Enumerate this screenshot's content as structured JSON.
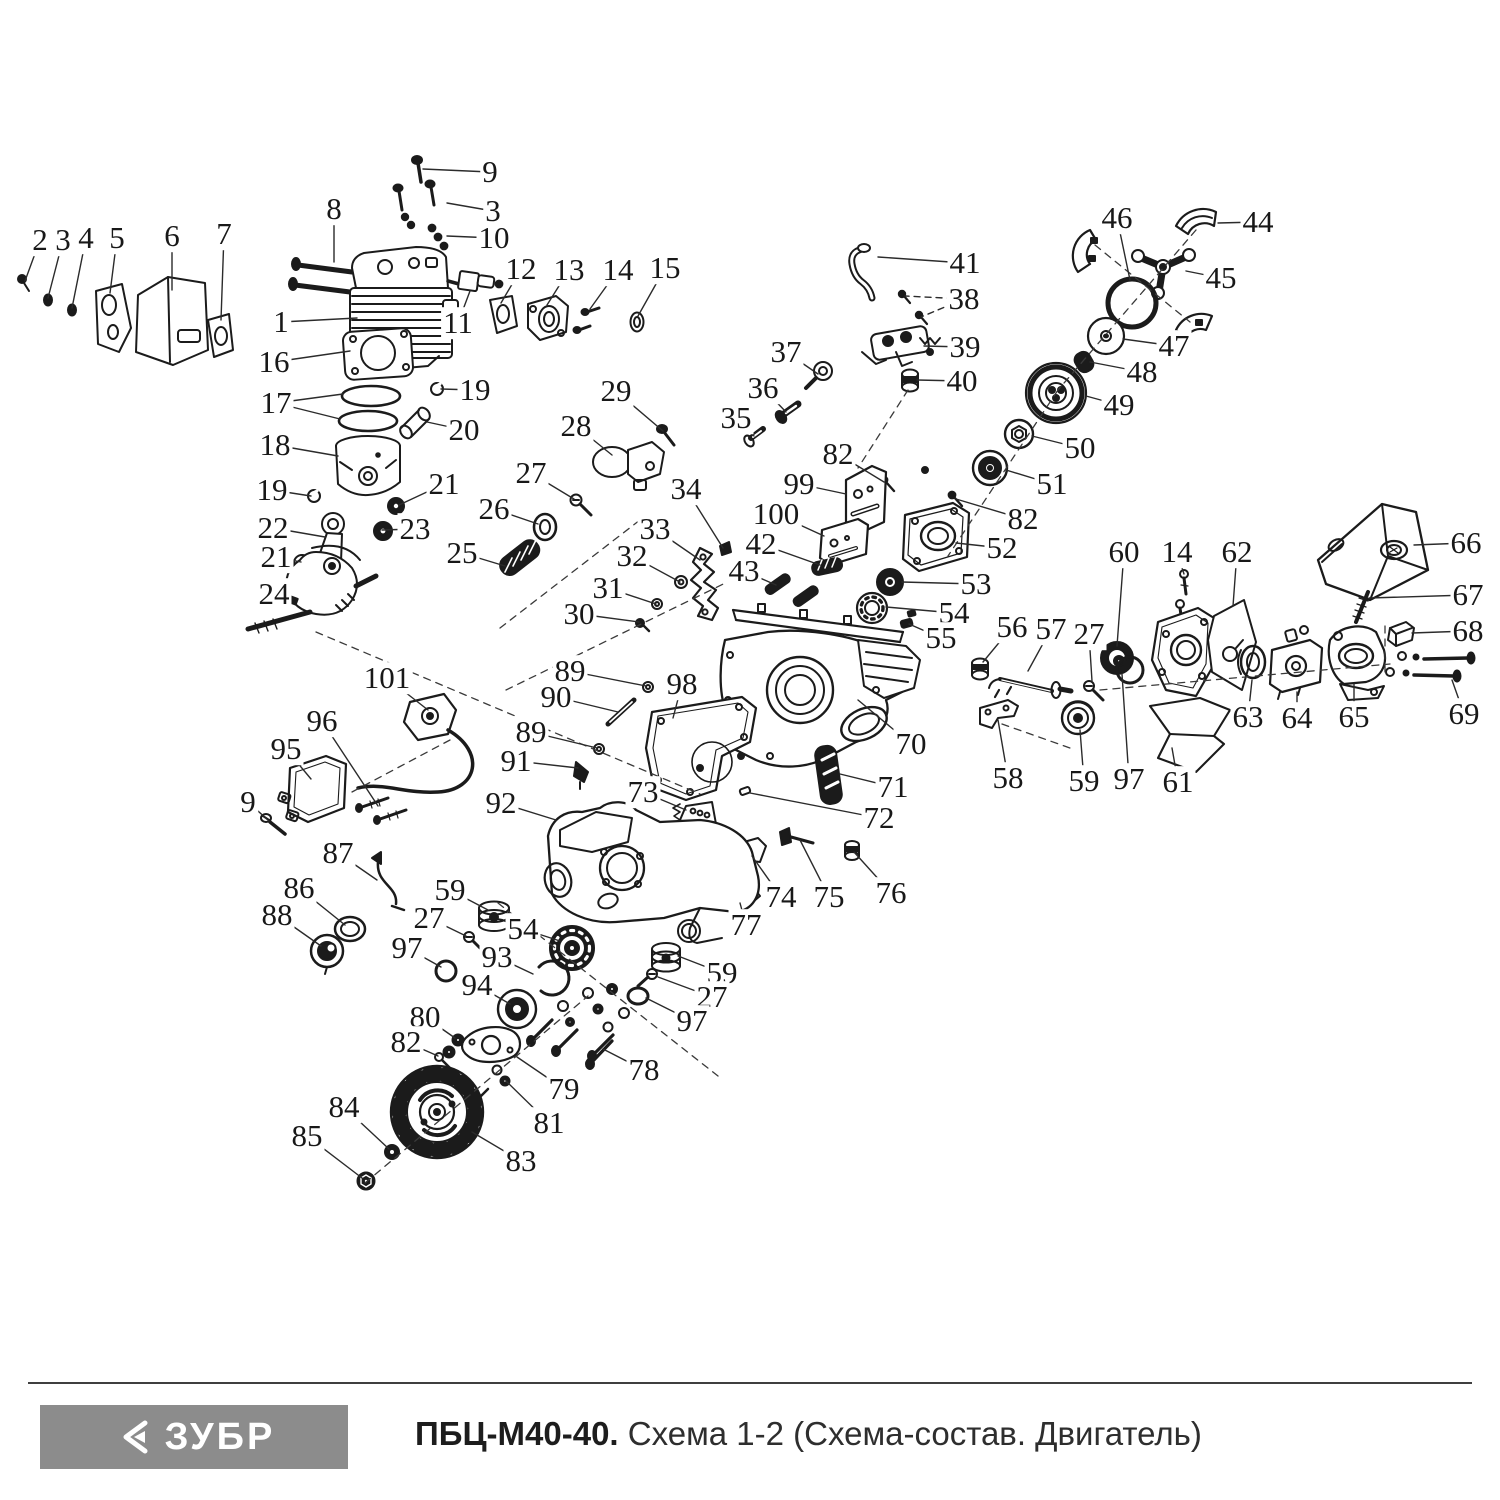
{
  "colors": {
    "ink": "#1b1b1b",
    "logo_gray": "#8c8c8c",
    "background": "#ffffff"
  },
  "footer": {
    "logo_text": "ЗУБР",
    "model": "ПБЦ-М40-40.",
    "subtitle": "Схема 1-2 (Схема-состав. Двигатель)"
  },
  "diagram": {
    "labels": [
      {
        "n": "2",
        "x": 40,
        "y": 240,
        "t": [
          25,
          281
        ]
      },
      {
        "n": "3",
        "x": 63,
        "y": 240,
        "t": [
          48,
          298
        ]
      },
      {
        "n": "4",
        "x": 86,
        "y": 238,
        "t": [
          72,
          308
        ]
      },
      {
        "n": "5",
        "x": 117,
        "y": 238,
        "t": [
          110,
          293
        ]
      },
      {
        "n": "6",
        "x": 172,
        "y": 236,
        "t": [
          172,
          290
        ]
      },
      {
        "n": "7",
        "x": 224,
        "y": 234,
        "t": [
          221,
          320
        ]
      },
      {
        "n": "8",
        "x": 334,
        "y": 209,
        "t": [
          334,
          262
        ]
      },
      {
        "n": "9",
        "x": 490,
        "y": 172,
        "t": [
          423,
          169
        ]
      },
      {
        "n": "3",
        "x": 493,
        "y": 211,
        "t": [
          447,
          203
        ]
      },
      {
        "n": "10",
        "x": 494,
        "y": 238,
        "t": [
          447,
          236
        ]
      },
      {
        "n": "1",
        "x": 281,
        "y": 322,
        "t": [
          357,
          318
        ]
      },
      {
        "n": "11",
        "x": 458,
        "y": 323,
        "t": [
          470,
          291
        ]
      },
      {
        "n": "12",
        "x": 521,
        "y": 269,
        "t": [
          501,
          303
        ]
      },
      {
        "n": "13",
        "x": 569,
        "y": 270,
        "t": [
          547,
          305
        ]
      },
      {
        "n": "14",
        "x": 618,
        "y": 270,
        "t": [
          590,
          309
        ]
      },
      {
        "n": "15",
        "x": 665,
        "y": 268,
        "t": [
          638,
          316
        ]
      },
      {
        "n": "16",
        "x": 274,
        "y": 362,
        "t": [
          350,
          351
        ]
      },
      {
        "n": "17",
        "x": 276,
        "y": 403,
        "t": [
          343,
          394
        ],
        "t2": [
          340,
          419
        ]
      },
      {
        "n": "18",
        "x": 275,
        "y": 445,
        "t": [
          338,
          456
        ]
      },
      {
        "n": "19",
        "x": 475,
        "y": 390,
        "t": [
          441,
          389
        ]
      },
      {
        "n": "20",
        "x": 464,
        "y": 430,
        "t": [
          427,
          422
        ]
      },
      {
        "n": "21",
        "x": 444,
        "y": 484,
        "t": [
          399,
          505
        ]
      },
      {
        "n": "19",
        "x": 272,
        "y": 490,
        "t": [
          311,
          496
        ]
      },
      {
        "n": "22",
        "x": 273,
        "y": 528,
        "t": [
          325,
          537
        ]
      },
      {
        "n": "23",
        "x": 415,
        "y": 529,
        "t": [
          382,
          530
        ]
      },
      {
        "n": "21",
        "x": 276,
        "y": 557,
        "t": [
          301,
          562
        ]
      },
      {
        "n": "24",
        "x": 274,
        "y": 594,
        "t": [
          291,
          600
        ]
      },
      {
        "n": "25",
        "x": 462,
        "y": 553,
        "t": [
          505,
          566
        ]
      },
      {
        "n": "26",
        "x": 494,
        "y": 509,
        "t": [
          538,
          524
        ]
      },
      {
        "n": "27",
        "x": 531,
        "y": 473,
        "t": [
          574,
          499
        ]
      },
      {
        "n": "28",
        "x": 576,
        "y": 426,
        "t": [
          612,
          455
        ]
      },
      {
        "n": "29",
        "x": 616,
        "y": 391,
        "t": [
          663,
          431
        ]
      },
      {
        "n": "30",
        "x": 579,
        "y": 614,
        "t": [
          639,
          622
        ]
      },
      {
        "n": "31",
        "x": 608,
        "y": 588,
        "t": [
          656,
          604
        ]
      },
      {
        "n": "32",
        "x": 632,
        "y": 556,
        "t": [
          680,
          582
        ]
      },
      {
        "n": "33",
        "x": 655,
        "y": 529,
        "t": [
          700,
          560
        ]
      },
      {
        "n": "34",
        "x": 686,
        "y": 489,
        "t": [
          723,
          548
        ]
      },
      {
        "n": "35",
        "x": 736,
        "y": 418,
        "t": [
          754,
          436
        ]
      },
      {
        "n": "36",
        "x": 763,
        "y": 388,
        "t": [
          786,
          412
        ]
      },
      {
        "n": "37",
        "x": 786,
        "y": 352,
        "t": [
          818,
          374
        ]
      },
      {
        "n": "38",
        "x": 964,
        "y": 299,
        "t": [
          905,
          296
        ],
        "t2": [
          921,
          317
        ],
        "dash": true
      },
      {
        "n": "39",
        "x": 965,
        "y": 347,
        "t": [
          924,
          346
        ]
      },
      {
        "n": "40",
        "x": 962,
        "y": 381,
        "t": [
          917,
          380
        ]
      },
      {
        "n": "41",
        "x": 965,
        "y": 263,
        "t": [
          878,
          257
        ]
      },
      {
        "n": "44",
        "x": 1258,
        "y": 222,
        "t": [
          1218,
          223
        ]
      },
      {
        "n": "45",
        "x": 1221,
        "y": 278,
        "t": [
          1186,
          271
        ]
      },
      {
        "n": "46",
        "x": 1117,
        "y": 218,
        "t": [
          1130,
          280
        ]
      },
      {
        "n": "47",
        "x": 1174,
        "y": 346,
        "t": [
          1123,
          339
        ]
      },
      {
        "n": "48",
        "x": 1142,
        "y": 372,
        "t": [
          1090,
          362
        ]
      },
      {
        "n": "49",
        "x": 1119,
        "y": 405,
        "t": [
          1086,
          396
        ]
      },
      {
        "n": "50",
        "x": 1080,
        "y": 448,
        "t": [
          1032,
          436
        ]
      },
      {
        "n": "51",
        "x": 1052,
        "y": 484,
        "t": [
          1006,
          470
        ]
      },
      {
        "n": "82",
        "x": 838,
        "y": 454,
        "t": [
          884,
          482
        ]
      },
      {
        "n": "82",
        "x": 1023,
        "y": 519,
        "t": [
          956,
          499
        ]
      },
      {
        "n": "99",
        "x": 799,
        "y": 484,
        "t": [
          846,
          494
        ]
      },
      {
        "n": "100",
        "x": 776,
        "y": 514,
        "t": [
          824,
          536
        ]
      },
      {
        "n": "42",
        "x": 761,
        "y": 544,
        "t": [
          820,
          565
        ]
      },
      {
        "n": "43",
        "x": 744,
        "y": 571,
        "t": [
          776,
          585
        ]
      },
      {
        "n": "52",
        "x": 1002,
        "y": 548,
        "t": [
          956,
          543
        ]
      },
      {
        "n": "53",
        "x": 976,
        "y": 584,
        "t": [
          902,
          582
        ]
      },
      {
        "n": "54",
        "x": 954,
        "y": 613,
        "t": [
          886,
          607
        ]
      },
      {
        "n": "55",
        "x": 941,
        "y": 638,
        "t": [
          909,
          624
        ]
      },
      {
        "n": "56",
        "x": 1012,
        "y": 627,
        "t": [
          983,
          662
        ]
      },
      {
        "n": "57",
        "x": 1051,
        "y": 629,
        "t": [
          1028,
          671
        ]
      },
      {
        "n": "27",
        "x": 1089,
        "y": 634,
        "t": [
          1092,
          681
        ]
      },
      {
        "n": "60",
        "x": 1124,
        "y": 552,
        "t": [
          1117,
          646
        ]
      },
      {
        "n": "14",
        "x": 1177,
        "y": 552,
        "t": [
          1184,
          574
        ]
      },
      {
        "n": "62",
        "x": 1237,
        "y": 552,
        "t": [
          1233,
          606
        ]
      },
      {
        "n": "66",
        "x": 1466,
        "y": 543,
        "t": [
          1414,
          545
        ]
      },
      {
        "n": "67",
        "x": 1468,
        "y": 595,
        "t": [
          1369,
          598
        ]
      },
      {
        "n": "68",
        "x": 1468,
        "y": 631,
        "t": [
          1412,
          633
        ]
      },
      {
        "n": "69",
        "x": 1464,
        "y": 714,
        "t": [
          1452,
          680
        ]
      },
      {
        "n": "63",
        "x": 1248,
        "y": 717,
        "t": [
          1252,
          680
        ]
      },
      {
        "n": "64",
        "x": 1297,
        "y": 718,
        "t": [
          1297,
          692
        ]
      },
      {
        "n": "65",
        "x": 1354,
        "y": 717,
        "t": [
          1354,
          684
        ]
      },
      {
        "n": "70",
        "x": 911,
        "y": 744,
        "t": [
          858,
          700
        ]
      },
      {
        "n": "71",
        "x": 893,
        "y": 787,
        "t": [
          840,
          774
        ]
      },
      {
        "n": "72",
        "x": 879,
        "y": 818,
        "t": [
          750,
          793
        ]
      },
      {
        "n": "58",
        "x": 1008,
        "y": 778,
        "t": [
          998,
          720
        ]
      },
      {
        "n": "59",
        "x": 1084,
        "y": 781,
        "t": [
          1080,
          730
        ]
      },
      {
        "n": "97",
        "x": 1129,
        "y": 779,
        "t": [
          1122,
          674
        ]
      },
      {
        "n": "61",
        "x": 1178,
        "y": 782,
        "t": [
          1172,
          748
        ]
      },
      {
        "n": "73",
        "x": 643,
        "y": 792,
        "t": [
          686,
          810
        ]
      },
      {
        "n": "74",
        "x": 781,
        "y": 897,
        "t": [
          752,
          856
        ]
      },
      {
        "n": "75",
        "x": 829,
        "y": 897,
        "t": [
          800,
          840
        ]
      },
      {
        "n": "76",
        "x": 891,
        "y": 893,
        "t": [
          854,
          852
        ]
      },
      {
        "n": "77",
        "x": 746,
        "y": 925,
        "t": [
          740,
          903
        ]
      },
      {
        "n": "89",
        "x": 570,
        "y": 671,
        "t": [
          646,
          686
        ]
      },
      {
        "n": "90",
        "x": 556,
        "y": 697,
        "t": [
          618,
          712
        ]
      },
      {
        "n": "98",
        "x": 682,
        "y": 684,
        "t": [
          673,
          718
        ]
      },
      {
        "n": "89",
        "x": 531,
        "y": 732,
        "t": [
          597,
          748
        ]
      },
      {
        "n": "91",
        "x": 516,
        "y": 761,
        "t": [
          578,
          768
        ]
      },
      {
        "n": "101",
        "x": 387,
        "y": 678,
        "t": [
          428,
          710
        ]
      },
      {
        "n": "96",
        "x": 322,
        "y": 721,
        "t": [
          378,
          806
        ]
      },
      {
        "n": "95",
        "x": 286,
        "y": 749,
        "t": [
          311,
          779
        ]
      },
      {
        "n": "9",
        "x": 248,
        "y": 802,
        "t": [
          269,
          821
        ]
      },
      {
        "n": "92",
        "x": 501,
        "y": 803,
        "t": [
          556,
          820
        ]
      },
      {
        "n": "87",
        "x": 338,
        "y": 853,
        "t": [
          377,
          880
        ]
      },
      {
        "n": "86",
        "x": 299,
        "y": 888,
        "t": [
          345,
          925
        ]
      },
      {
        "n": "88",
        "x": 277,
        "y": 915,
        "t": [
          321,
          946
        ]
      },
      {
        "n": "59",
        "x": 450,
        "y": 890,
        "t": [
          488,
          910
        ]
      },
      {
        "n": "27",
        "x": 429,
        "y": 918,
        "t": [
          466,
          936
        ]
      },
      {
        "n": "97",
        "x": 407,
        "y": 948,
        "t": [
          441,
          967
        ]
      },
      {
        "n": "54",
        "x": 523,
        "y": 929,
        "t": [
          560,
          941
        ]
      },
      {
        "n": "93",
        "x": 497,
        "y": 957,
        "t": [
          533,
          974
        ]
      },
      {
        "n": "94",
        "x": 477,
        "y": 985,
        "t": [
          510,
          1004
        ]
      },
      {
        "n": "59",
        "x": 722,
        "y": 973,
        "t": [
          678,
          956
        ]
      },
      {
        "n": "27",
        "x": 712,
        "y": 997,
        "t": [
          658,
          977
        ]
      },
      {
        "n": "97",
        "x": 692,
        "y": 1021,
        "t": [
          646,
          998
        ]
      },
      {
        "n": "80",
        "x": 425,
        "y": 1017,
        "t": [
          455,
          1038
        ]
      },
      {
        "n": "82",
        "x": 406,
        "y": 1042,
        "t": [
          438,
          1056
        ]
      },
      {
        "n": "78",
        "x": 644,
        "y": 1070,
        "t": [
          603,
          1049
        ]
      },
      {
        "n": "79",
        "x": 564,
        "y": 1089,
        "t": [
          517,
          1057
        ]
      },
      {
        "n": "81",
        "x": 549,
        "y": 1123,
        "t": [
          506,
          1081
        ]
      },
      {
        "n": "84",
        "x": 344,
        "y": 1107,
        "t": [
          389,
          1149
        ]
      },
      {
        "n": "85",
        "x": 307,
        "y": 1136,
        "t": [
          362,
          1178
        ]
      },
      {
        "n": "83",
        "x": 521,
        "y": 1161,
        "t": [
          472,
          1132
        ]
      }
    ]
  }
}
